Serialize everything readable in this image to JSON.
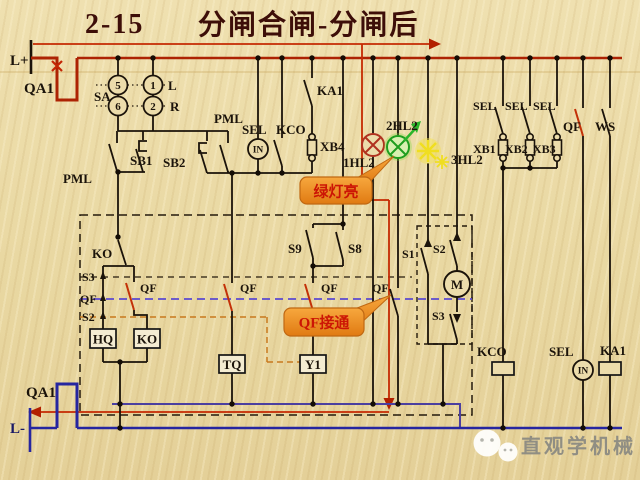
{
  "title": {
    "code": "2-15",
    "text": "分闸合闸-分闸后"
  },
  "power_rails": {
    "positive": "L+",
    "negative": "L-",
    "breaker_top": "QA1",
    "breaker_bottom": "QA1"
  },
  "selector": {
    "label": "SA",
    "pin_top_left": "5",
    "pin_top_right": "1",
    "pin_bottom_left": "6",
    "pin_bottom_right": "2",
    "dir_left": "L",
    "dir_right": "R"
  },
  "branch_buttons": {
    "pml_left": "PML",
    "sb1": "SB1",
    "sb2": "SB2",
    "pml_right": "PML"
  },
  "monitor_branch": {
    "sel": "SEL",
    "kco": "KCO",
    "in": "IN",
    "xb4": "XB4",
    "ka1": "KA1"
  },
  "lamps": {
    "red": "1HL2",
    "green": "2HL2",
    "yellow": "3HL2"
  },
  "interlock": {
    "ko_contact": "KO",
    "s3": "S3",
    "qf": "QF",
    "s2": "S2",
    "qf_ko": "QF",
    "qf_tq": "QF",
    "qf_y1": "QF",
    "qf_lamp": "QF",
    "s9": "S9",
    "s8": "S8"
  },
  "motor_box": {
    "s1": "S1",
    "s2": "S2",
    "s3": "S3",
    "motor": "M"
  },
  "sel_fuses": {
    "sel1": "SEL",
    "sel2": "SEL",
    "sel3": "SEL",
    "xb1": "XB1",
    "xb2": "XB2",
    "xb3": "XB3",
    "qf": "QF",
    "ws": "WS"
  },
  "coils": {
    "hq": "HQ",
    "ko": "KO",
    "tq": "TQ",
    "y1": "Y1",
    "kco": "KCO",
    "sel": "SEL",
    "in": "IN",
    "ka1": "KA1"
  },
  "callouts": {
    "green_on": "绿灯亮",
    "qf_closed": "QF接通"
  },
  "watermark": "直观学机械",
  "colors": {
    "background": "#ead9a4",
    "positive_bus": "#ad2303",
    "negative_bus": "#2626a0",
    "mid_return_bus": "#4b3fa0",
    "current_trace": "#c52a02",
    "green_lamp": "#1f9e1f",
    "red_lamp": "#b03220",
    "yellow_lamp": "#f0de20",
    "qf_linkage": "#5b4ad0",
    "s2_linkage": "#c8791e",
    "callout_fill": "#ef9328",
    "callout_text": "#cc1505",
    "title": "#3d0e08"
  }
}
